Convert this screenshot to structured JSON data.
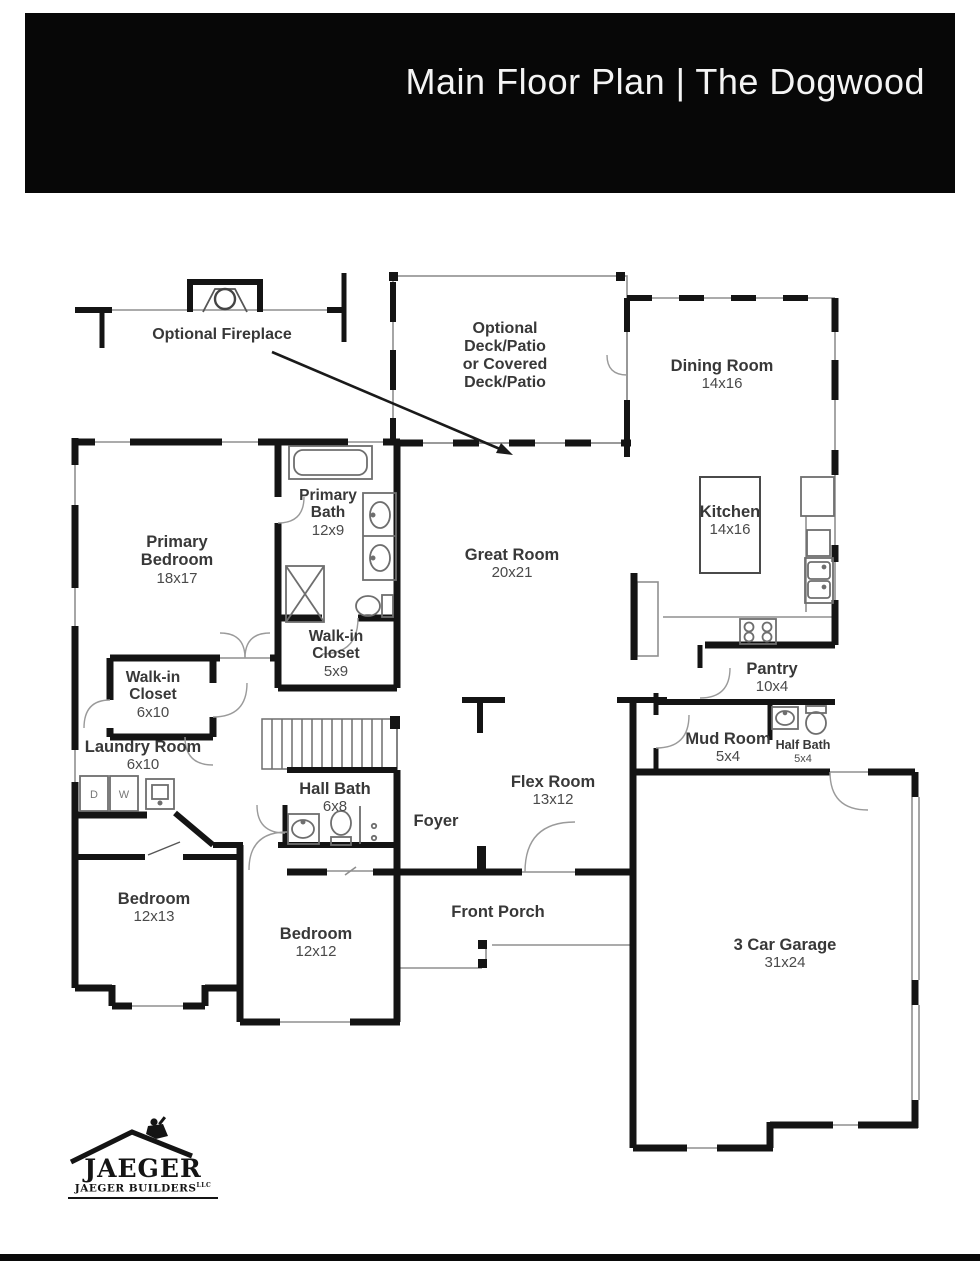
{
  "header": {
    "title": "Main Floor Plan | The Dogwood"
  },
  "rooms": {
    "fireplace_note": {
      "name": "Optional Fireplace"
    },
    "deck": {
      "l1": "Optional",
      "l2": "Deck/Patio",
      "l3": "or Covered",
      "l4": "Deck/Patio"
    },
    "dining": {
      "name": "Dining Room",
      "dims": "14x16"
    },
    "kitchen": {
      "name": "Kitchen",
      "dims": "14x16"
    },
    "great": {
      "name": "Great Room",
      "dims": "20x21"
    },
    "primary_bedroom": {
      "l1": "Primary",
      "l2": "Bedroom",
      "dims": "18x17"
    },
    "primary_bath": {
      "l1": "Primary",
      "l2": "Bath",
      "dims": "12x9"
    },
    "wic_59": {
      "l1": "Walk-in",
      "l2": "Closet",
      "dims": "5x9"
    },
    "wic_610": {
      "l1": "Walk-in",
      "l2": "Closet",
      "dims": "6x10"
    },
    "laundry": {
      "name": "Laundry Room",
      "dims": "6x10"
    },
    "hall_bath": {
      "name": "Hall Bath",
      "dims": "6x8"
    },
    "pantry": {
      "name": "Pantry",
      "dims": "10x4"
    },
    "mud_room": {
      "name": "Mud Room",
      "dims": "5x4"
    },
    "half_bath": {
      "name": "Half Bath",
      "dims": "5x4"
    },
    "flex": {
      "name": "Flex Room",
      "dims": "13x12"
    },
    "foyer": {
      "name": "Foyer"
    },
    "front_porch": {
      "name": "Front Porch"
    },
    "bedroom_1": {
      "name": "Bedroom",
      "dims": "12x13"
    },
    "bedroom_2": {
      "name": "Bedroom",
      "dims": "12x12"
    },
    "garage": {
      "name": "3 Car Garage",
      "dims": "31x24"
    }
  },
  "laundry_appliances": {
    "dryer": "D",
    "washer": "W"
  },
  "logo": {
    "brand": "JAEGER",
    "company": "JAEGER BUILDERS",
    "suffix": "LLC"
  },
  "colors": {
    "wall": "#141414",
    "thin_line": "#8f8f8f",
    "label": "#383838",
    "header_bg": "#070707",
    "header_text": "#f4f4f4",
    "background": "#ffffff"
  }
}
